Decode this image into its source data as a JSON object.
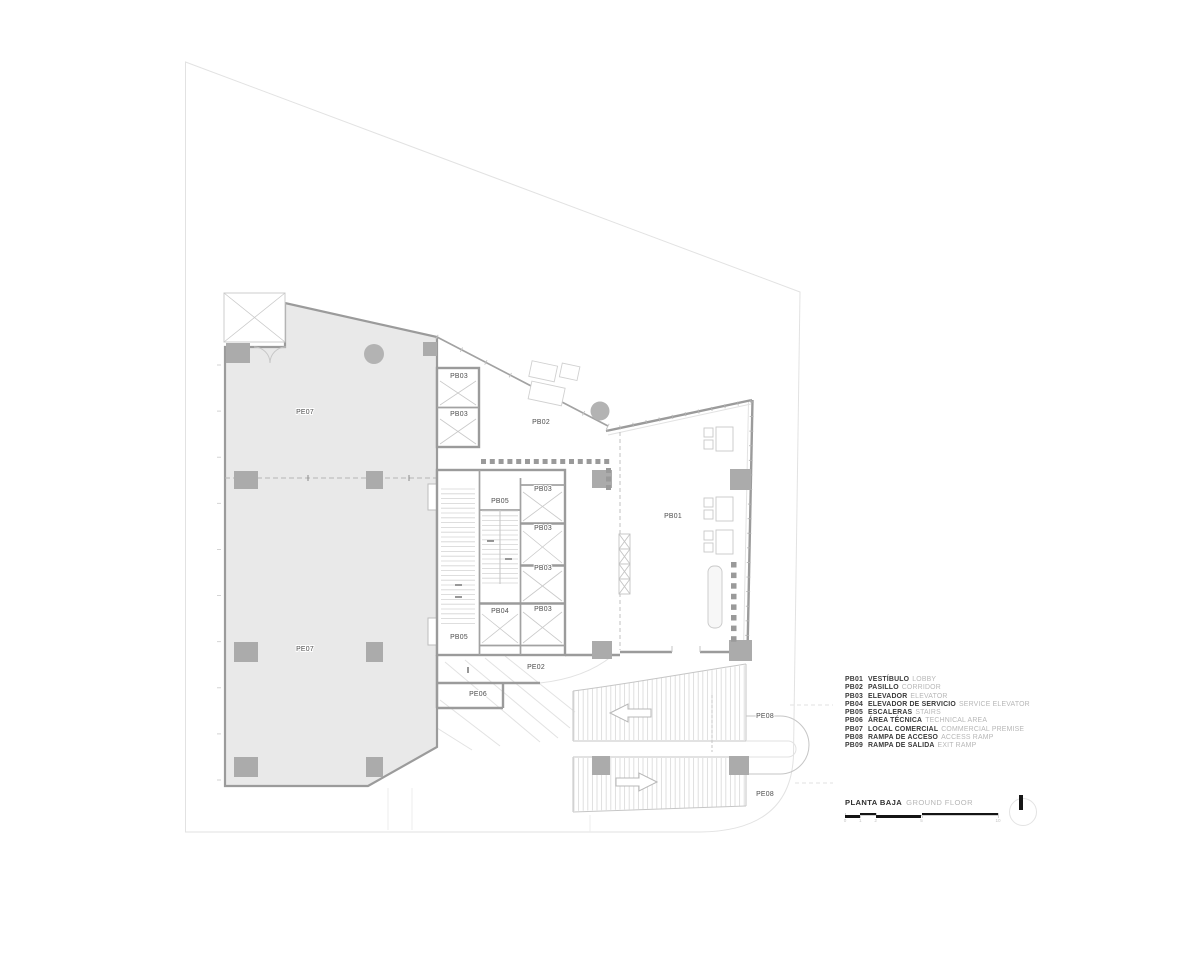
{
  "drawing": {
    "type_note": "architectural floor plan",
    "colors": {
      "room_fill": "#e9e9e9",
      "column_fill": "#ababab",
      "wall": "#9b9b9b",
      "thin_line": "#c6c6c6",
      "label_text": "#4d4d4d",
      "legend_dark": "#3a3a3a",
      "legend_light": "#b7b7b7",
      "scalebar_black": "#141414"
    },
    "room_labels": {
      "pe07_upper": "PE07",
      "pe07_lower": "PE07",
      "pb03_top_a": "PB03",
      "pb03_top_b": "PB03",
      "pb02": "PB02",
      "pb05_core": "PB05",
      "pb03_1": "PB03",
      "pb03_2": "PB03",
      "pb03_3": "PB03",
      "pb03_4": "PB03",
      "pb04": "PB04",
      "pb05_lower": "PB05",
      "pb01": "PB01",
      "pe02": "PE02",
      "pe06": "PE06",
      "pe08_access": "PE08",
      "pe08_exit": "PE08"
    }
  },
  "legend": {
    "items": [
      {
        "code": "PB01",
        "es": "VESTÍBULO",
        "en": "LOBBY"
      },
      {
        "code": "PB02",
        "es": "PASILLO",
        "en": "CORRIDOR"
      },
      {
        "code": "PB03",
        "es": "ELEVADOR",
        "en": "ELEVATOR"
      },
      {
        "code": "PB04",
        "es": "ELEVADOR DE SERVICIO",
        "en": "SERVICE ELEVATOR"
      },
      {
        "code": "PB05",
        "es": "ESCALERAS",
        "en": "STAIRS"
      },
      {
        "code": "PB06",
        "es": "ÁREA TÉCNICA",
        "en": "TECHNICAL AREA"
      },
      {
        "code": "PB07",
        "es": "LOCAL COMERCIAL",
        "en": "COMMERCIAL PREMISE"
      },
      {
        "code": "PB08",
        "es": "RAMPA DE ACCESO",
        "en": "ACCESS RAMP"
      },
      {
        "code": "PB09",
        "es": "RAMPA DE SALIDA",
        "en": "EXIT RAMP"
      }
    ]
  },
  "titleblock": {
    "title_es": "PLANTA BAJA",
    "title_en": "GROUND FLOOR",
    "scale_ticks": [
      "0",
      "1",
      "2",
      "5",
      "10"
    ]
  }
}
